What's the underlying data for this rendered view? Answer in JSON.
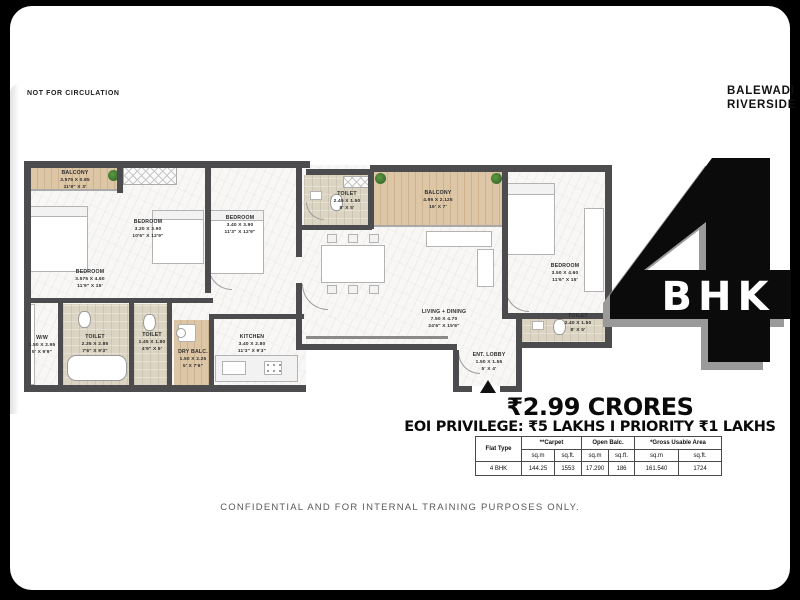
{
  "header": {
    "watermark": "NOT FOR CIRCULATION",
    "brand_line1": "BALEWADI",
    "brand_line2": "RIVERSIDE"
  },
  "hero": {
    "number": "4",
    "label": "BHK"
  },
  "pricing": {
    "price": "₹2.99 CRORES",
    "privilege": "EOI PRIVILEGE: ₹5 LAKHS I PRIORITY ₹1 LAKHS"
  },
  "floorplan": {
    "rooms": [
      {
        "name": "BALCONY",
        "dim_m": "3.575 X 0.95",
        "dim_ft": "11'9\" X 3'"
      },
      {
        "name": "BEDROOM",
        "dim_m": "3.575 X 4.60",
        "dim_ft": "11'9\" X 15'"
      },
      {
        "name": "BEDROOM",
        "dim_m": "3.20 X 3.90",
        "dim_ft": "10'6\" X 12'9\""
      },
      {
        "name": "BEDROOM",
        "dim_m": "3.40 X 3.90",
        "dim_ft": "11'3\" X 12'9\""
      },
      {
        "name": "TOILET",
        "dim_m": "2.45 X 1.50",
        "dim_ft": "8' X 5'"
      },
      {
        "name": "BALCONY",
        "dim_m": "4.95 X 2.125",
        "dim_ft": "16' X 7'"
      },
      {
        "name": "BEDROOM",
        "dim_m": "3.50 X 4.60",
        "dim_ft": "11'6\" X 15'"
      },
      {
        "name": "TOILET",
        "dim_m": "2.40 X 1.50",
        "dim_ft": "8' X 5'"
      },
      {
        "name": "LIVING + DINING",
        "dim_m": "7.50 X 4.70",
        "dim_ft": "24'6\" X 15'6\""
      },
      {
        "name": "ENT. LOBBY",
        "dim_m": "1.50 X 1.55",
        "dim_ft": "5' X 4'"
      },
      {
        "name": "W/W",
        "dim_m": "1.50 X 2.95",
        "dim_ft": "5' X 9'9\""
      },
      {
        "name": "TOILET",
        "dim_m": "2.35 X 2.85",
        "dim_ft": "7'6\" X 9'3\""
      },
      {
        "name": "TOILET",
        "dim_m": "1.45 X 1.80",
        "dim_ft": "4'9\" X 6'"
      },
      {
        "name": "DRY BALC.",
        "dim_m": "1.50 X 2.25",
        "dim_ft": "5' X 7'6\""
      },
      {
        "name": "KITCHEN",
        "dim_m": "3.40 X 2.80",
        "dim_ft": "11'3\" X 9'3\""
      }
    ]
  },
  "area_table": {
    "col_groups": [
      "Flat Type",
      "**Carpet",
      "Open Balc.",
      "*Gross Usable Area"
    ],
    "unit_headers": [
      "sq.m",
      "sq.ft.",
      "sq.m",
      "sq.ft.",
      "sq.m",
      "sq.ft."
    ],
    "rows": [
      [
        "4 BHK",
        "144.25",
        "1553",
        "17.290",
        "186",
        "161.540",
        "1724"
      ]
    ]
  },
  "footer": {
    "disclaimer": "CONFIDENTIAL AND FOR INTERNAL TRAINING PURPOSES ONLY."
  }
}
